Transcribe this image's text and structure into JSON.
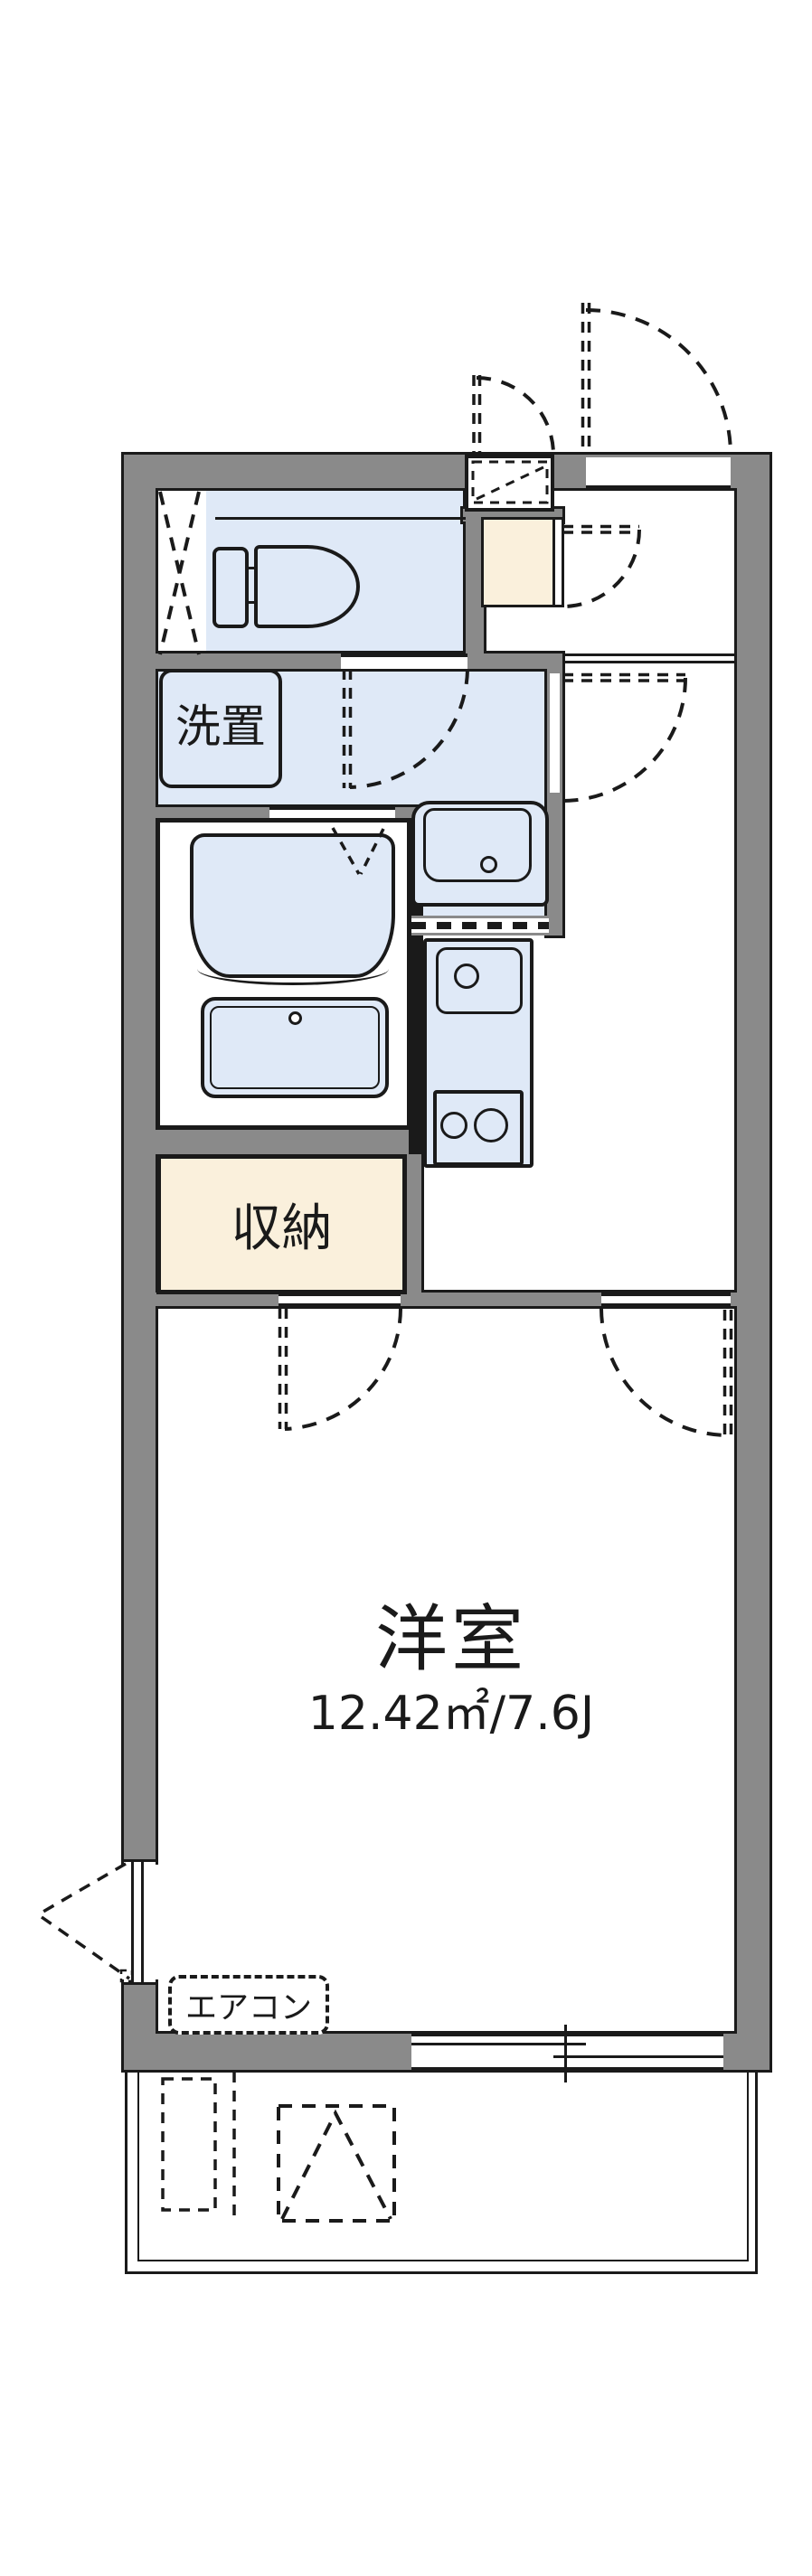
{
  "plan": {
    "title": "apartment-floor-plan",
    "rooms": {
      "main_room": {
        "label": "洋室",
        "area": "12.42㎡/7.6J"
      },
      "storage": {
        "label": "収納"
      },
      "laundry": {
        "label": "洗置"
      },
      "aircon": {
        "label": "エアコン"
      }
    },
    "colors": {
      "wall": "#8a8a8a",
      "outline": "#1a1a1a",
      "floor_blue": "#dfe9f7",
      "floor_cream": "#faf0dc"
    }
  }
}
